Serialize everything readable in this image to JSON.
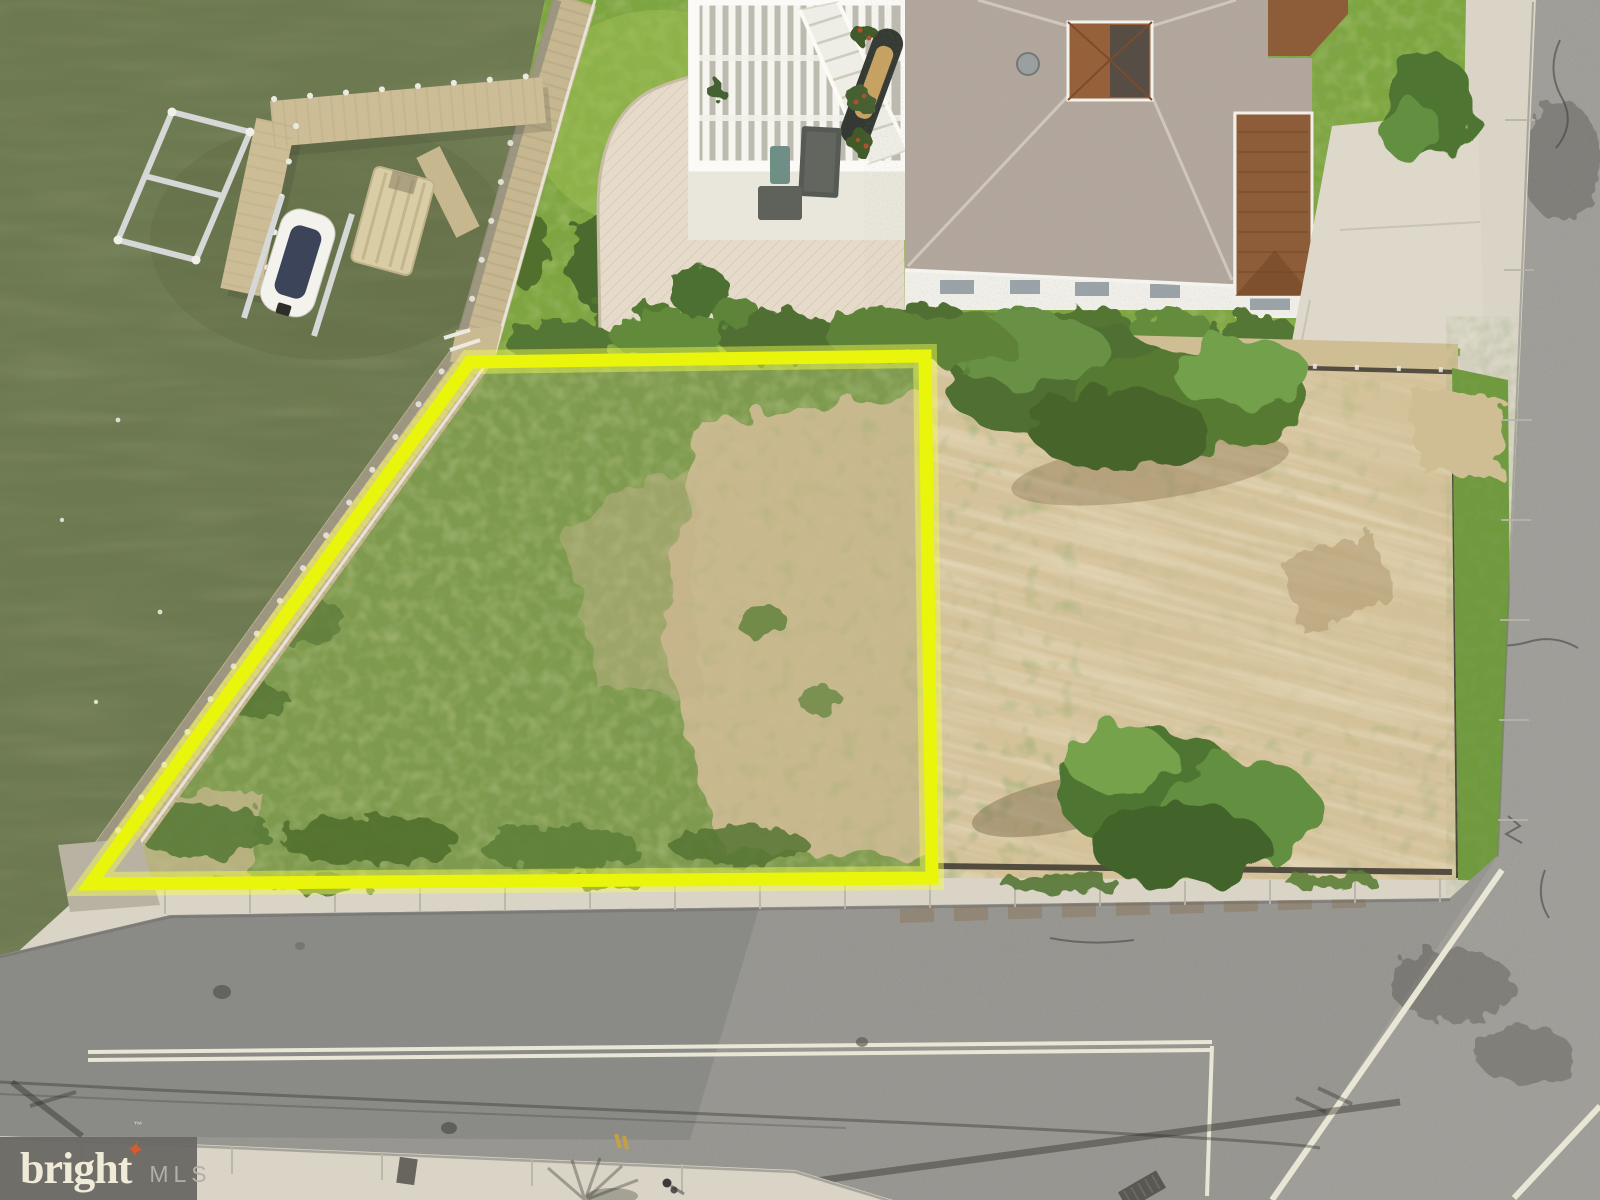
{
  "scene": {
    "description": "Aerial drone photo of a waterfront vacant building lot outlined in yellow, beside a bayfront house with dock, cleared dirt lot, and bordering roads",
    "watermark": {
      "brand": "bright",
      "star": "✦",
      "tm": "™",
      "suffix": "MLS"
    },
    "colors": {
      "water": "#6d7950",
      "grass_lot": "#7e9a4d",
      "lawn": "#7da63f",
      "dirt": "#d4c29a",
      "road": "#989792",
      "road_dark": "#8a8a86",
      "concrete": "#d9d4c6",
      "boardwalk": "#c6b791",
      "dock_wood": "#ccbd97",
      "roof_gray": "#b2a79c",
      "roof_brown": "#8d5c38",
      "deck": "#e9e7dc",
      "house_wall": "#f0efe9",
      "outline_yellow": "#e9f50a",
      "marking_white": "#eae6d6"
    }
  }
}
